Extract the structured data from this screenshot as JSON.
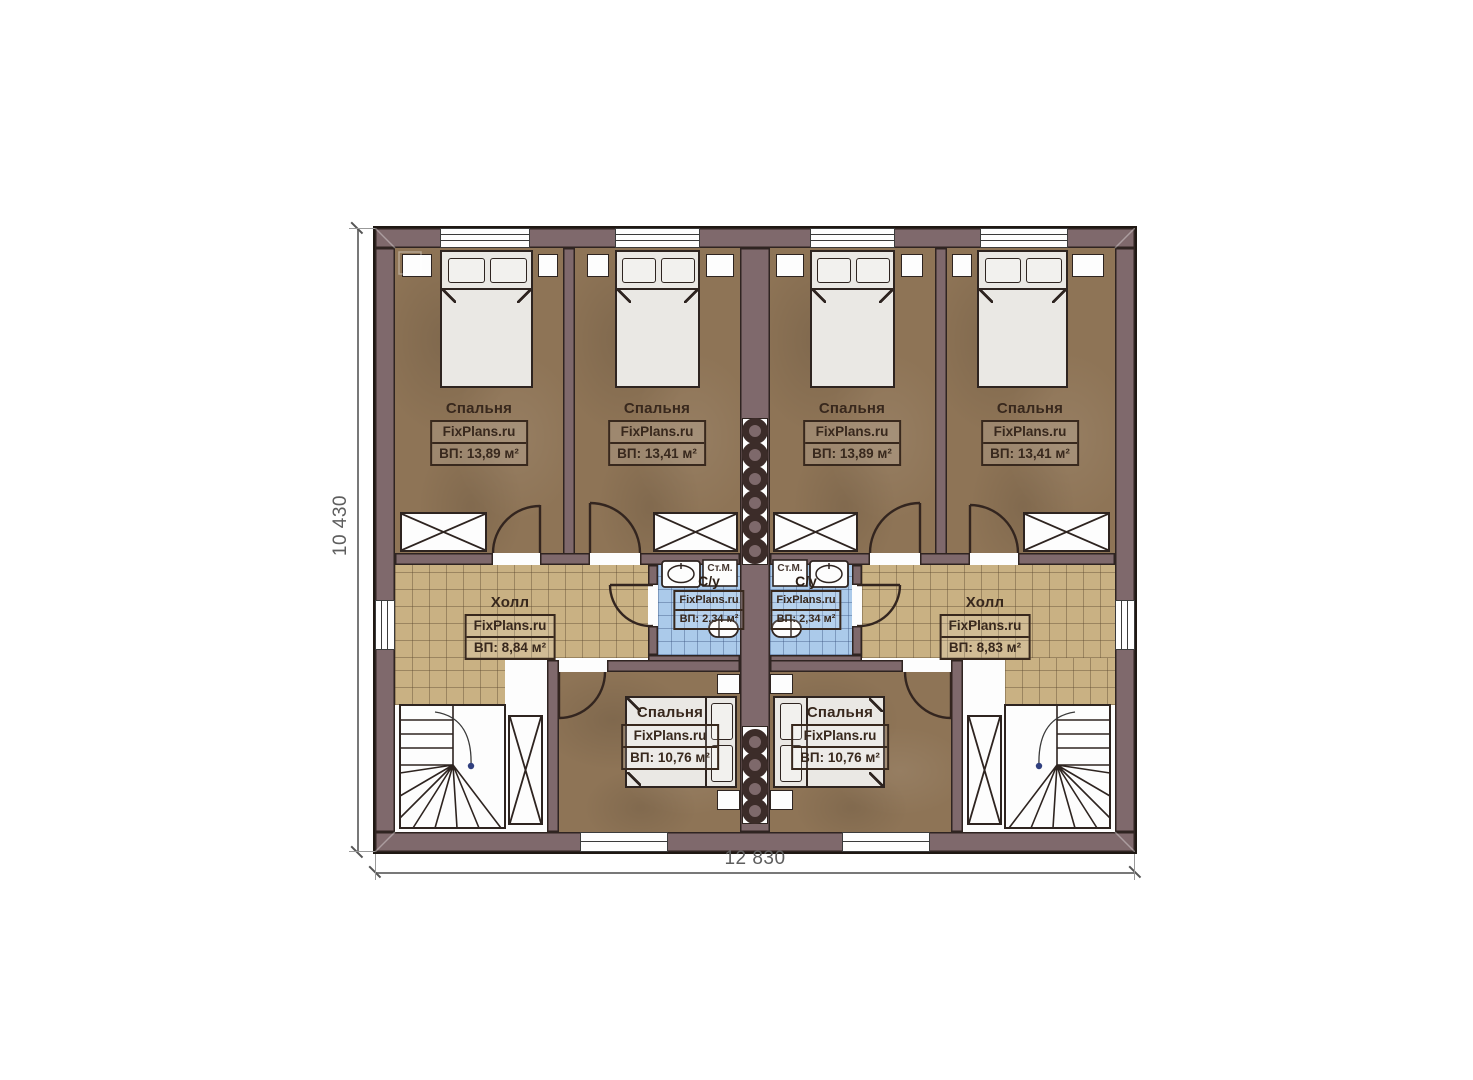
{
  "dimensions": {
    "width_label": "12 830",
    "height_label": "10 430"
  },
  "rooms": {
    "bedroom_1": {
      "name": "Спальня",
      "brand": "FixPlans.ru",
      "area": "ВП: 13,89 м²"
    },
    "bedroom_2": {
      "name": "Спальня",
      "brand": "FixPlans.ru",
      "area": "ВП: 13,41 м²"
    },
    "bedroom_3": {
      "name": "Спальня",
      "brand": "FixPlans.ru",
      "area": "ВП: 13,89 м²"
    },
    "bedroom_4": {
      "name": "Спальня",
      "brand": "FixPlans.ru",
      "area": "ВП: 13,41 м²"
    },
    "hall_left": {
      "name": "Холл",
      "brand": "FixPlans.ru",
      "area": "ВП: 8,84 м²"
    },
    "hall_right": {
      "name": "Холл",
      "brand": "FixPlans.ru",
      "area": "ВП: 8,83 м²"
    },
    "bath_left": {
      "name": "С/у",
      "brand": "FixPlans.ru",
      "area": "ВП: 2,34 м²",
      "washer": "Ст.М."
    },
    "bath_right": {
      "name": "С/у",
      "brand": "FixPlans.ru",
      "area": "ВП: 2,34 м²",
      "washer": "Ст.М."
    },
    "bedroom_5": {
      "name": "Спальня",
      "brand": "FixPlans.ru",
      "area": "ВП: 10,76 м²"
    },
    "bedroom_6": {
      "name": "Спальня",
      "brand": "FixPlans.ru",
      "area": "ВП: 10,76 м²"
    }
  }
}
